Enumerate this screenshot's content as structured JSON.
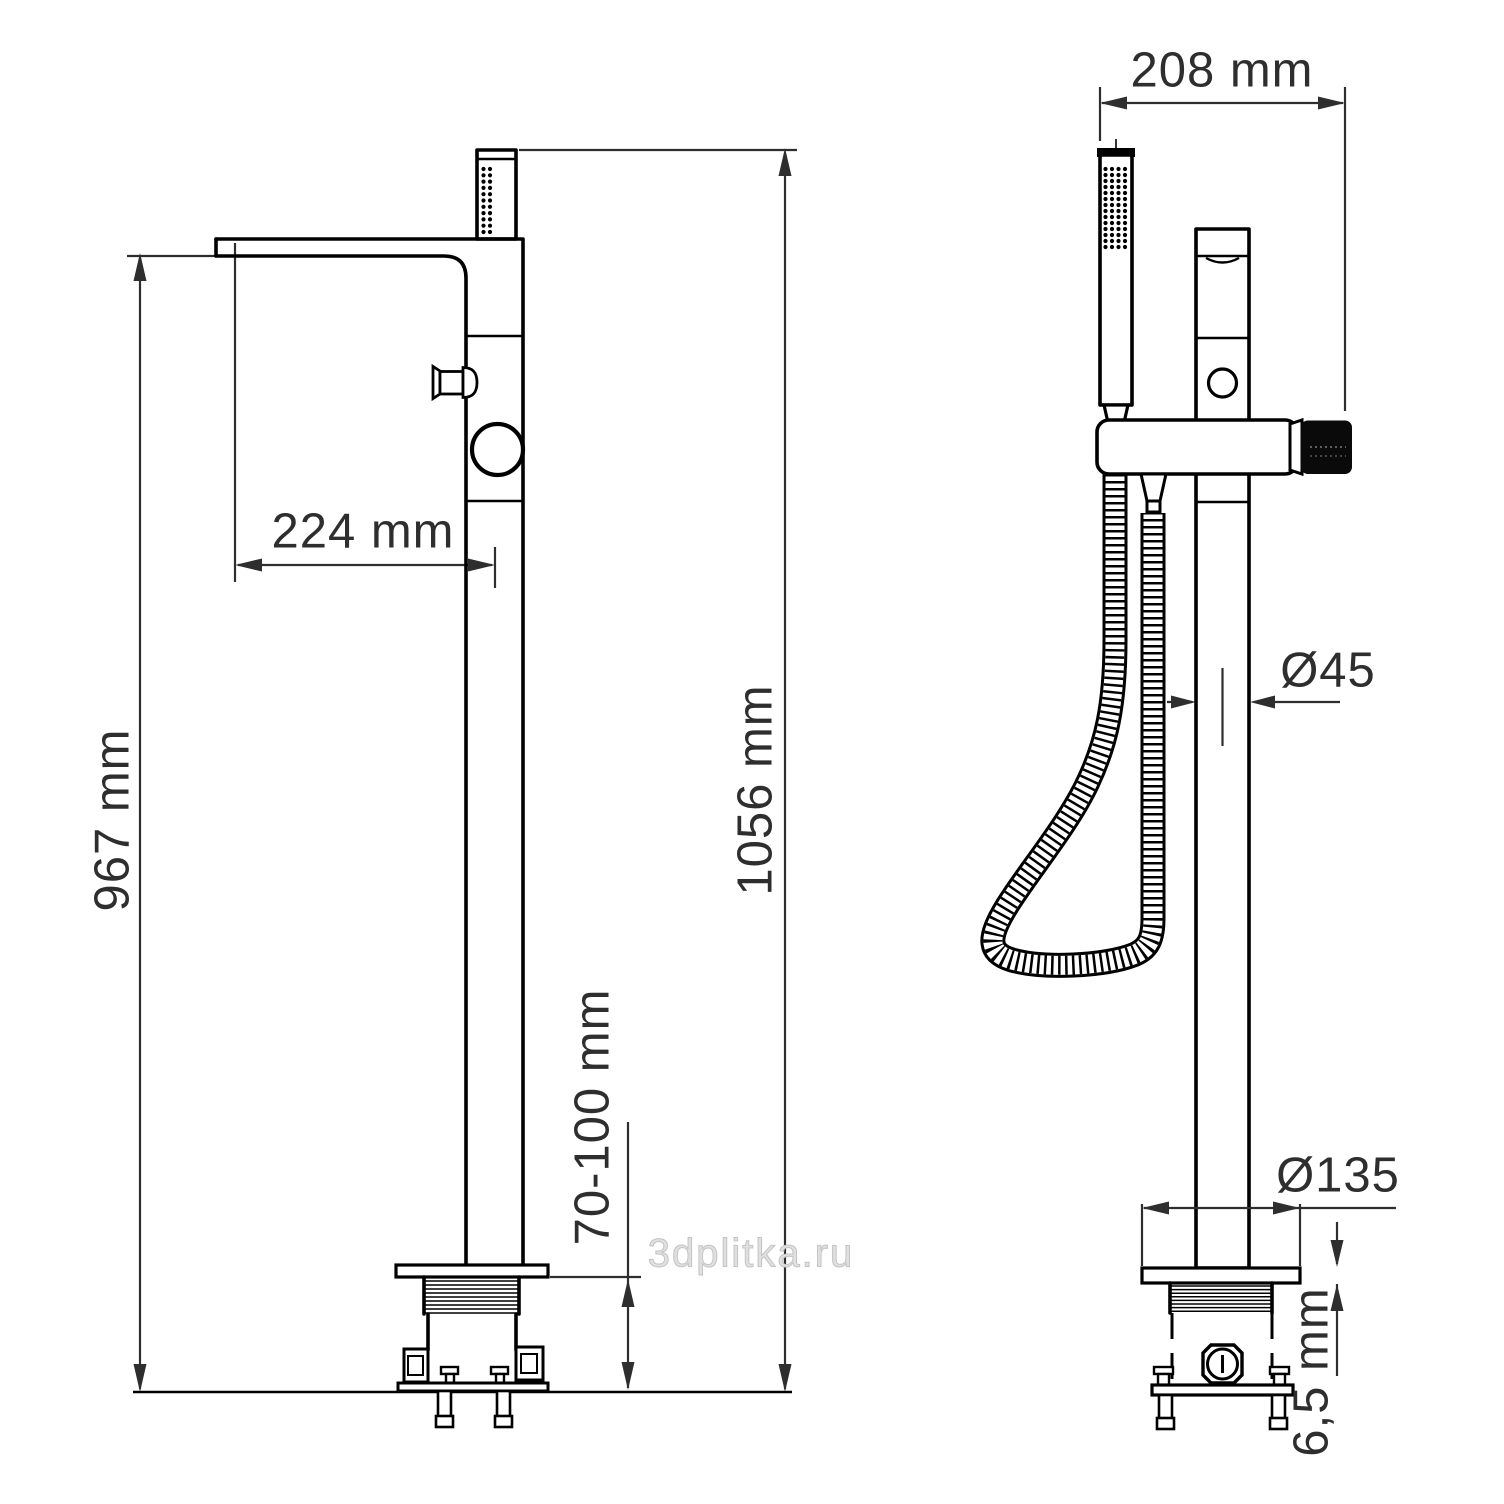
{
  "dimensions": {
    "handle_width": "208 mm",
    "spout_reach": "224 mm",
    "spout_height": "967 mm",
    "total_height": "1056 mm",
    "floor_clearance": "70-100 mm",
    "column_diameter": "Ø45",
    "base_diameter": "Ø135",
    "base_thickness": "6,5 mm"
  },
  "watermark": "3dplitka.ru",
  "colors": {
    "line": "#000000",
    "dimension_text": "#2e2e2e",
    "knob": "#0a0a0a",
    "watermark": "#c4c4c4",
    "background": "#ffffff"
  }
}
